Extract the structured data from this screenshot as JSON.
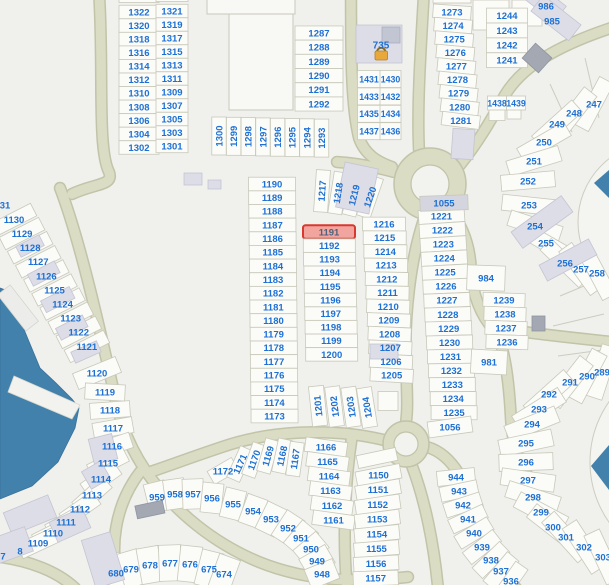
{
  "map": {
    "highlight": {
      "label": "1191"
    },
    "colors": {
      "background": "#f0f1ed",
      "parcel_fill": "#fbfbf8",
      "parcel_stroke": "#c8c9ba",
      "label_color": "#1d70d4",
      "highlight_fill": "#f2a49e",
      "highlight_stroke": "#d8382e",
      "highlight_text": "#4f617c",
      "road": "#dadcc3",
      "water": "#4181ab",
      "building": "#dcdde7"
    },
    "map_labels": [
      {
        "t": "735",
        "x": 381,
        "y": 45,
        "fs": 10
      },
      {
        "t": "986",
        "x": 546,
        "y": 6
      },
      {
        "t": "985",
        "x": 552,
        "y": 21
      },
      {
        "t": "31",
        "x": 5,
        "y": 205
      },
      {
        "t": "8",
        "x": 20,
        "y": 551
      },
      {
        "t": "7",
        "x": 3,
        "y": 556
      }
    ],
    "parcel_groups": [
      {
        "id": "block-nw-left",
        "cx": 139,
        "cy": 12,
        "dy": 13.55,
        "w": 40,
        "h": 13.5,
        "labels": [
          "1322",
          "1320",
          "1318",
          "1316",
          "1314",
          "1312",
          "1310",
          "1308",
          "1306",
          "1304",
          "1302"
        ]
      },
      {
        "id": "block-nw-right",
        "cx": 172,
        "cy": 11,
        "dy": 13.5,
        "w": 32,
        "h": 13.4,
        "labels": [
          "1321",
          "1319",
          "1317",
          "1315",
          "1313",
          "1311",
          "1309",
          "1307",
          "1305",
          "1303",
          "1301"
        ]
      },
      {
        "id": "strip-1287",
        "cx": 319,
        "cy": 33,
        "dy": 14.2,
        "w": 48,
        "h": 14.1,
        "labels": [
          "1287",
          "1288",
          "1289",
          "1290",
          "1291",
          "1292"
        ]
      },
      {
        "id": "row-1293",
        "cx": 219,
        "cy": 136,
        "dx": 14.65,
        "dy": 0.3,
        "w": 14.4,
        "h": 38,
        "tr": -90,
        "labels": [
          "1300",
          "1299",
          "1298",
          "1297",
          "1296",
          "1295",
          "1294",
          "1293"
        ]
      },
      {
        "id": "grid-1431-left",
        "cx": 369,
        "cy": 79,
        "dy": 17.4,
        "w": 23,
        "h": 17,
        "fs": 8.8,
        "labels": [
          "1431",
          "1433",
          "1435",
          "1437"
        ]
      },
      {
        "id": "grid-1431-right",
        "cx": 390.5,
        "cy": 79,
        "dy": 17.4,
        "w": 21,
        "h": 17,
        "fs": 8.8,
        "labels": [
          "1430",
          "1432",
          "1434",
          "1436"
        ]
      },
      {
        "id": "col-1244",
        "cx": 507,
        "cy": 15.5,
        "dy": 14.9,
        "w": 41,
        "h": 14.8,
        "labels": [
          "1244",
          "1243",
          "1242",
          "1241"
        ]
      },
      {
        "id": "row-1438",
        "w": 19,
        "h": 14,
        "fs": 8.8,
        "cells": [
          {
            "t": "1438",
            "x": 497,
            "y": 103
          },
          {
            "t": "1439",
            "x": 516,
            "y": 103
          }
        ]
      },
      {
        "id": "col-1273",
        "cx": 452,
        "cy": 12,
        "dx": 1.1,
        "dy": 13.55,
        "rot": 4,
        "drot": 0.4,
        "w": 38,
        "h": 13.5,
        "labels": [
          "1273",
          "1274",
          "1275",
          "1276",
          "1277",
          "1278",
          "1279",
          "1280",
          "1281"
        ]
      },
      {
        "id": "col-1190",
        "cx": 272,
        "cy": 184,
        "dx": 0.15,
        "dy": 13.65,
        "w": 47,
        "h": 13.6,
        "labels": [
          "1190",
          "1189",
          "1188",
          "1187",
          "1186",
          "1185",
          "1184",
          "1183",
          "1182",
          "1181",
          "1180",
          "1179",
          "1178",
          "1177",
          "1176",
          "1175",
          "1174",
          "1173"
        ]
      },
      {
        "id": "col-1191",
        "cx": 329,
        "cy": 232,
        "dx": 0.3,
        "dy": 13.6,
        "w": 52,
        "h": 13.5,
        "labels": [
          "1191",
          "1192",
          "1193",
          "1194",
          "1195",
          "1196",
          "1197",
          "1198",
          "1199",
          "1200"
        ]
      },
      {
        "id": "strip-1217",
        "w": 14,
        "h": 42,
        "tr": -90,
        "cells": [
          {
            "t": "1217",
            "x": 322,
            "y": 191,
            "r": 4
          },
          {
            "t": "1218",
            "x": 338,
            "y": 193,
            "r": 9
          },
          {
            "t": "1219",
            "x": 354,
            "y": 195,
            "r": 14
          },
          {
            "t": "1220",
            "x": 370,
            "y": 197,
            "r": 19
          }
        ]
      },
      {
        "id": "col-1216",
        "cx": 384,
        "cy": 224,
        "dx": 0.7,
        "dy": 13.75,
        "drot": 0.3,
        "w": 43,
        "h": 13.7,
        "labels": [
          "1216",
          "1215",
          "1214",
          "1213",
          "1212",
          "1211",
          "1210",
          "1209",
          "1208",
          "1207",
          "1206",
          "1205"
        ]
      },
      {
        "id": "strip-1201",
        "w": 15,
        "h": 40,
        "tr": -90,
        "cells": [
          {
            "t": "1201",
            "x": 318,
            "y": 406,
            "r": -6
          },
          {
            "t": "1202",
            "x": 334.5,
            "y": 406.5,
            "r": -7
          },
          {
            "t": "1203",
            "x": 351,
            "y": 407,
            "r": -8
          },
          {
            "t": "1204",
            "x": 367,
            "y": 407.5,
            "r": -9
          }
        ]
      },
      {
        "id": "col-1221",
        "cx": 441.5,
        "cy": 216,
        "dx": 0.9,
        "dy": 14.05,
        "rot": -4,
        "drot": 0.3,
        "w": 46,
        "h": 14,
        "labels": [
          "1221",
          "1222",
          "1223",
          "1224",
          "1225",
          "1226",
          "1227",
          "1228",
          "1229",
          "1230",
          "1231",
          "1232",
          "1233",
          "1234",
          "1235"
        ]
      },
      {
        "id": "cell-1056",
        "w": 44,
        "h": 16,
        "cells": [
          {
            "t": "1056",
            "x": 450,
            "y": 427,
            "r": -8
          }
        ]
      },
      {
        "id": "cell-1055",
        "w": 48,
        "h": 15,
        "fill": "#d4d5df",
        "cells": [
          {
            "t": "1055",
            "x": 444,
            "y": 203,
            "r": -2
          }
        ]
      },
      {
        "id": "col-984",
        "w": 42,
        "h": 14,
        "cells": [
          {
            "t": "984",
            "x": 486,
            "y": 278,
            "r": 2,
            "w": 38,
            "h": 25
          },
          {
            "t": "1239",
            "x": 504,
            "y": 300,
            "r": 2
          },
          {
            "t": "1238",
            "x": 505,
            "y": 314,
            "r": 2
          },
          {
            "t": "1237",
            "x": 506,
            "y": 328,
            "r": 2
          },
          {
            "t": "1236",
            "x": 507,
            "y": 342,
            "r": 2
          },
          {
            "t": "981",
            "x": 489,
            "y": 362,
            "r": 3,
            "w": 36,
            "h": 24
          }
        ]
      },
      {
        "id": "col-1166",
        "cx": 326,
        "cy": 447,
        "dx": 1.5,
        "dy": 14.6,
        "rot": 8,
        "w": 42,
        "h": 14.5,
        "labels": [
          "1166",
          "1165",
          "1164",
          "1163",
          "1162",
          "1161"
        ]
      },
      {
        "id": "col-1150",
        "cx": 378.5,
        "cy": 475,
        "dx": -0.4,
        "dy": 14.75,
        "rot": -11,
        "drot": 1.3,
        "w": 45,
        "h": 14.6,
        "labels": [
          "1150",
          "1151",
          "1152",
          "1153",
          "1154",
          "1155",
          "1156",
          "1157"
        ]
      },
      {
        "id": "strip-1167",
        "w": 14,
        "h": 34,
        "tr": -90,
        "cells": [
          {
            "t": "1172",
            "x": 223,
            "y": 471,
            "r": -30,
            "w": 28,
            "h": 15,
            "tr": 0
          },
          {
            "t": "1171",
            "x": 240,
            "y": 464,
            "r": 24
          },
          {
            "t": "1170",
            "x": 254,
            "y": 460,
            "r": 20
          },
          {
            "t": "1169",
            "x": 268,
            "y": 456,
            "r": 16
          },
          {
            "t": "1168",
            "x": 282,
            "y": 456,
            "r": 12
          },
          {
            "t": "1167",
            "x": 295,
            "y": 459,
            "r": 8
          }
        ]
      },
      {
        "id": "col-1120s",
        "cx": 14,
        "cy": 219.5,
        "dx": 8.1,
        "dy": 14.1,
        "rot": -27,
        "w": 44,
        "h": 14,
        "labels": [
          "1130",
          "1129",
          "1128",
          "1127",
          "1126",
          "1125",
          "1124",
          "1123",
          "1122",
          "1121"
        ]
      },
      {
        "id": "cell-1120",
        "w": 46,
        "h": 17,
        "cells": [
          {
            "t": "1120",
            "x": 97,
            "y": 373,
            "r": -22
          }
        ]
      },
      {
        "id": "arc-1109",
        "w": 40,
        "h": 16,
        "cells": [
          {
            "t": "1119",
            "x": 105,
            "y": 392,
            "r": 3
          },
          {
            "t": "1118",
            "x": 110,
            "y": 410,
            "r": -4
          },
          {
            "t": "1117",
            "x": 113,
            "y": 428,
            "r": -10
          },
          {
            "t": "1116",
            "x": 112,
            "y": 446,
            "r": -18
          },
          {
            "t": "1115",
            "x": 108,
            "y": 463,
            "r": -27
          },
          {
            "t": "1114",
            "x": 101,
            "y": 479,
            "r": -35
          },
          {
            "t": "1113",
            "x": 92,
            "y": 495,
            "r": -42
          },
          {
            "t": "1112",
            "x": 80,
            "y": 509,
            "r": -35
          },
          {
            "t": "1111",
            "x": 66,
            "y": 522,
            "r": -30
          },
          {
            "t": "1110",
            "x": 53,
            "y": 533,
            "r": -27
          },
          {
            "t": "1109",
            "x": 38,
            "y": 543,
            "r": -25
          }
        ]
      },
      {
        "id": "fan-950s",
        "w": 21,
        "h": 30,
        "cells": [
          {
            "t": "959",
            "x": 157,
            "y": 497,
            "r": -14
          },
          {
            "t": "958",
            "x": 175,
            "y": 494,
            "r": -8
          },
          {
            "t": "957",
            "x": 193,
            "y": 494,
            "r": -2
          },
          {
            "t": "956",
            "x": 212,
            "y": 498,
            "r": 6
          },
          {
            "t": "955",
            "x": 233,
            "y": 504,
            "r": 14
          },
          {
            "t": "954",
            "x": 253,
            "y": 511,
            "r": 20
          },
          {
            "t": "953",
            "x": 271,
            "y": 519,
            "r": 26
          },
          {
            "t": "952",
            "x": 288,
            "y": 528,
            "r": 33
          },
          {
            "t": "951",
            "x": 301,
            "y": 538,
            "r": 40
          },
          {
            "t": "950",
            "x": 311,
            "y": 549,
            "r": 50
          },
          {
            "t": "949",
            "x": 317,
            "y": 561,
            "r": 60
          },
          {
            "t": "948",
            "x": 322,
            "y": 574,
            "r": 68
          }
        ]
      },
      {
        "id": "strip-940s",
        "w": 38,
        "h": 15,
        "cells": [
          {
            "t": "944",
            "x": 456,
            "y": 477,
            "r": -6
          },
          {
            "t": "943",
            "x": 459,
            "y": 491,
            "r": -12
          },
          {
            "t": "942",
            "x": 463,
            "y": 505,
            "r": -18
          },
          {
            "t": "941",
            "x": 468,
            "y": 519,
            "r": -25
          },
          {
            "t": "940",
            "x": 474,
            "y": 533,
            "r": -31
          },
          {
            "t": "939",
            "x": 482,
            "y": 547,
            "r": -38
          },
          {
            "t": "938",
            "x": 491,
            "y": 560,
            "r": -44
          },
          {
            "t": "937",
            "x": 501,
            "y": 571,
            "r": -50
          },
          {
            "t": "936",
            "x": 511,
            "y": 581,
            "r": -55
          }
        ]
      },
      {
        "id": "fan-670s",
        "w": 22,
        "h": 36,
        "cells": [
          {
            "t": "680",
            "x": 116,
            "y": 573,
            "r": -24
          },
          {
            "t": "679",
            "x": 131,
            "y": 569,
            "r": -17
          },
          {
            "t": "678",
            "x": 150,
            "y": 565,
            "r": -10
          },
          {
            "t": "677",
            "x": 170,
            "y": 563,
            "r": -2
          },
          {
            "t": "676",
            "x": 190,
            "y": 564,
            "r": 6
          },
          {
            "t": "675",
            "x": 209,
            "y": 569,
            "r": 14
          },
          {
            "t": "674",
            "x": 224,
            "y": 574,
            "r": 20
          }
        ]
      },
      {
        "id": "fan-290s",
        "w": 54,
        "h": 17,
        "cells": [
          {
            "t": "289",
            "x": 602,
            "y": 372,
            "r": -72
          },
          {
            "t": "290",
            "x": 587,
            "y": 376,
            "r": -62
          },
          {
            "t": "291",
            "x": 570,
            "y": 382,
            "r": -52
          },
          {
            "t": "292",
            "x": 549,
            "y": 394,
            "r": -42
          },
          {
            "t": "293",
            "x": 539,
            "y": 409,
            "r": -32
          },
          {
            "t": "294",
            "x": 532,
            "y": 424,
            "r": -22
          },
          {
            "t": "295",
            "x": 526,
            "y": 443,
            "r": -12
          },
          {
            "t": "296",
            "x": 526,
            "y": 462,
            "r": -2
          },
          {
            "t": "297",
            "x": 528,
            "y": 480,
            "r": 8
          },
          {
            "t": "298",
            "x": 533,
            "y": 497,
            "r": 18
          },
          {
            "t": "299",
            "x": 541,
            "y": 512,
            "r": 28
          },
          {
            "t": "300",
            "x": 553,
            "y": 527,
            "r": 38
          },
          {
            "t": "301",
            "x": 566,
            "y": 537,
            "r": 48
          },
          {
            "t": "302",
            "x": 584,
            "y": 547,
            "r": 57
          },
          {
            "t": "303",
            "x": 603,
            "y": 557,
            "r": 65
          }
        ]
      },
      {
        "id": "fan-250s",
        "w": 54,
        "h": 16,
        "cells": [
          {
            "t": "247",
            "x": 594,
            "y": 104,
            "r": -62
          },
          {
            "t": "248",
            "x": 574,
            "y": 113,
            "r": -52
          },
          {
            "t": "249",
            "x": 557,
            "y": 124,
            "r": -42
          },
          {
            "t": "250",
            "x": 544,
            "y": 142,
            "r": -30
          },
          {
            "t": "251",
            "x": 534,
            "y": 161,
            "r": -17
          },
          {
            "t": "252",
            "x": 528,
            "y": 181,
            "r": -5
          },
          {
            "t": "253",
            "x": 529,
            "y": 205,
            "r": 6
          },
          {
            "t": "254",
            "x": 535,
            "y": 226,
            "r": 18
          },
          {
            "t": "255",
            "x": 546,
            "y": 243,
            "r": 30
          },
          {
            "t": "256",
            "x": 565,
            "y": 263,
            "r": 44
          },
          {
            "t": "257",
            "x": 581,
            "y": 269,
            "r": 54
          },
          {
            "t": "258",
            "x": 597,
            "y": 273,
            "r": 62
          }
        ]
      }
    ],
    "free_cells": [
      {
        "x": 139,
        "y": -4,
        "w": 40,
        "h": 13
      },
      {
        "x": 172,
        "y": -5,
        "w": 32,
        "h": 13
      },
      {
        "x": 452,
        "y": -3,
        "w": 38,
        "h": 12
      },
      {
        "x": 491,
        "y": 15,
        "w": 36,
        "h": 30
      },
      {
        "x": 527,
        "y": 13,
        "w": 30,
        "h": 26
      },
      {
        "x": 497,
        "y": 115,
        "w": 16,
        "h": 11
      },
      {
        "x": 514,
        "y": 114,
        "w": 14,
        "h": 10
      },
      {
        "x": 388,
        "y": 401,
        "w": 20,
        "h": 19
      },
      {
        "x": 377,
        "y": 458,
        "w": 40,
        "h": 13,
        "r": -12
      }
    ]
  }
}
